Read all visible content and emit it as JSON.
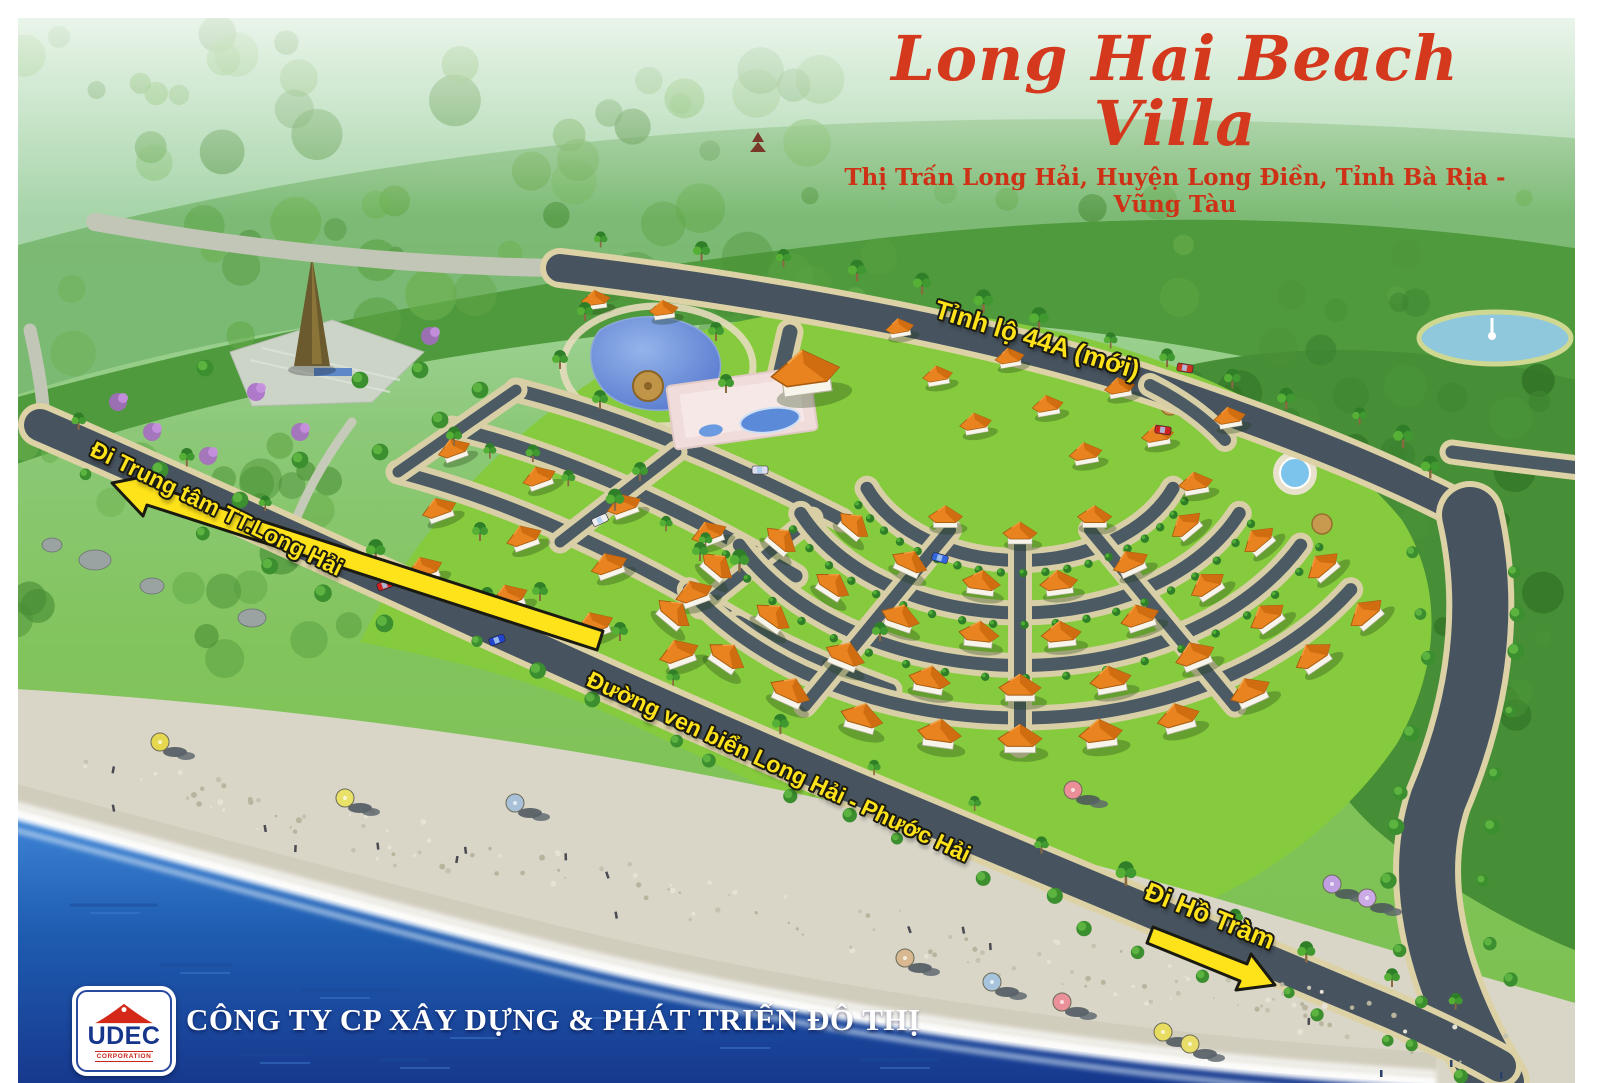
{
  "poster": {
    "title": "Long Hai Beach Villa",
    "subtitle": "Thị Trấn Long Hải, Huyện Long Điền, Tỉnh Bà Rịa - Vũng Tàu"
  },
  "road_labels": {
    "highway": "Tỉnh lộ 44A (mới)",
    "coastal_road": "Đường ven biển Long Hải - Phước Hải"
  },
  "direction_labels": {
    "to_town_center": "Đi Trung tâm TT.Long Hải",
    "to_ho_tram": "Đi Hồ Tràm"
  },
  "footer": {
    "logo_text": "UDEC",
    "logo_subtext": "CORPORATION",
    "company_name": "CÔNG TY CP XÂY DỰNG & PHÁT TRIỂN ĐÔ THỊ"
  },
  "colors": {
    "title_red": "#d5391d",
    "label_yellow": "#ffe31a",
    "road_gray": "#47545f",
    "sidewalk_tan": "#ddd2a6",
    "lawn_green": "#85cb3d",
    "forest_green": "#4f9a3c",
    "roof_orange": "#e8831f",
    "lake_blue": "#5b7fd0",
    "sea_blue": "#1d55aa",
    "sand": "#d9d6c8",
    "logo_blue": "#16368c",
    "logo_red": "#d42818"
  }
}
